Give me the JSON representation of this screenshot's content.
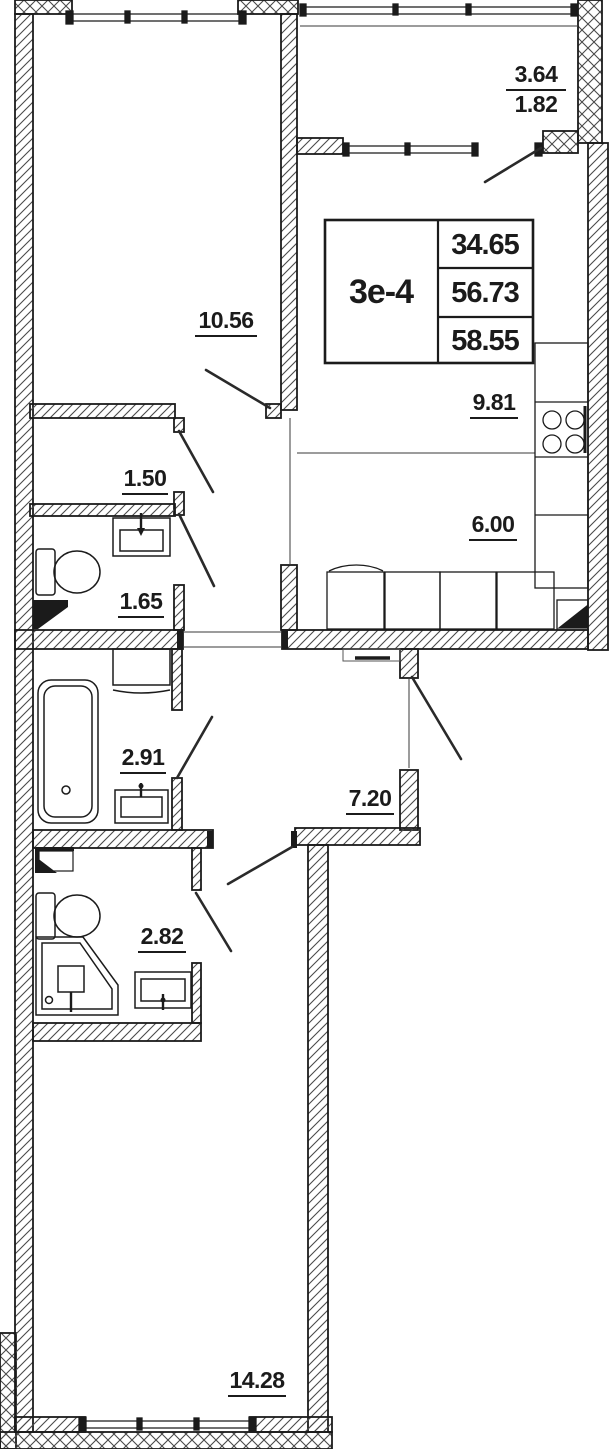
{
  "plan": {
    "title_block": {
      "unit_type": "3е-4",
      "values": [
        "34.65",
        "56.73",
        "58.55"
      ]
    },
    "rooms": {
      "balcony": {
        "area": "3.64",
        "reduced_area": "1.82"
      },
      "living_room_top": {
        "area": "10.56"
      },
      "kitchen": {
        "area": "9.81"
      },
      "kitchen_zone": {
        "area": "6.00"
      },
      "corridor_small": {
        "area": "1.50"
      },
      "wc": {
        "area": "1.65"
      },
      "bathroom": {
        "area": "2.91"
      },
      "hallway": {
        "area": "7.20"
      },
      "shower_room": {
        "area": "2.82"
      },
      "living_room_bottom": {
        "area": "14.28"
      }
    },
    "colors": {
      "wall_line": "#1b1b1b",
      "hatch_line": "#4a4a4a",
      "background": "#ffffff"
    }
  }
}
